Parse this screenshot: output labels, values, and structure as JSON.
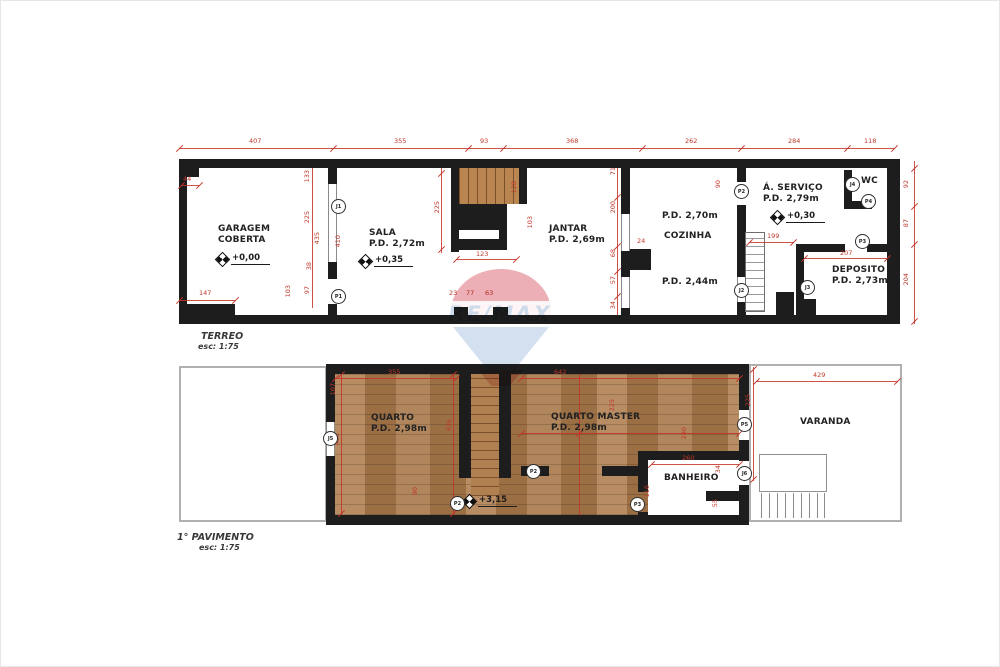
{
  "watermark": {
    "brand": "RE/MAX",
    "canopy_color": "#d95f6c",
    "bottom_color": "#a6c2e0"
  },
  "floors": [
    {
      "name": "TERREO",
      "scale": "esc: 1:75",
      "rooms": [
        {
          "lines": [
            "GARAGEM",
            "COBERTA"
          ],
          "x": 217,
          "y": 223
        },
        {
          "lines": [
            "SALA",
            "P.D. 2,72m"
          ],
          "x": 368,
          "y": 227
        },
        {
          "lines": [
            "JANTAR",
            "P.D. 2,69m"
          ],
          "x": 548,
          "y": 223
        },
        {
          "lines": [
            "P.D. 2,70m"
          ],
          "x": 661,
          "y": 210
        },
        {
          "lines": [
            "COZINHA"
          ],
          "x": 663,
          "y": 230
        },
        {
          "lines": [
            "P.D. 2,44m"
          ],
          "x": 661,
          "y": 276
        },
        {
          "lines": [
            "Á. SERVIÇO",
            "P.D. 2,79m"
          ],
          "x": 762,
          "y": 182
        },
        {
          "lines": [
            "WC"
          ],
          "x": 860,
          "y": 175
        },
        {
          "lines": [
            "DEPOSITO",
            "P.D. 2,73m"
          ],
          "x": 831,
          "y": 264
        }
      ],
      "levels": [
        {
          "t": "+0,00",
          "x": 216,
          "y": 252
        },
        {
          "t": "+0,35",
          "x": 359,
          "y": 254
        },
        {
          "t": "+0,30",
          "x": 771,
          "y": 210
        }
      ],
      "tags": [
        {
          "t": "J1",
          "x": 330,
          "y": 198
        },
        {
          "t": "P1",
          "x": 330,
          "y": 288
        },
        {
          "t": "P2",
          "x": 733,
          "y": 183
        },
        {
          "t": "J2",
          "x": 733,
          "y": 282
        },
        {
          "t": "J3",
          "x": 799,
          "y": 279
        },
        {
          "t": "J4",
          "x": 844,
          "y": 176
        },
        {
          "t": "P4",
          "x": 860,
          "y": 193
        },
        {
          "t": "P3",
          "x": 854,
          "y": 233
        }
      ],
      "dims": [
        {
          "t": "407",
          "x": 248,
          "y": 137
        },
        {
          "t": "355",
          "x": 393,
          "y": 137
        },
        {
          "t": "93",
          "x": 479,
          "y": 137
        },
        {
          "t": "368",
          "x": 565,
          "y": 137
        },
        {
          "t": "262",
          "x": 684,
          "y": 137
        },
        {
          "t": "284",
          "x": 787,
          "y": 137
        },
        {
          "t": "118",
          "x": 863,
          "y": 137
        },
        {
          "t": "44",
          "x": 182,
          "y": 175
        },
        {
          "t": "147",
          "x": 198,
          "y": 289
        },
        {
          "t": "123",
          "x": 475,
          "y": 250
        },
        {
          "t": "199",
          "x": 766,
          "y": 232
        },
        {
          "t": "207",
          "x": 839,
          "y": 249
        },
        {
          "t": "23",
          "x": 448,
          "y": 289
        },
        {
          "t": "77",
          "x": 465,
          "y": 289
        },
        {
          "t": "63",
          "x": 484,
          "y": 289
        },
        {
          "t": "24",
          "x": 636,
          "y": 237
        },
        {
          "t": "133",
          "x": 303,
          "y": 169,
          "r": 1
        },
        {
          "t": "225",
          "x": 303,
          "y": 210,
          "r": 1
        },
        {
          "t": "435",
          "x": 313,
          "y": 231,
          "r": 1
        },
        {
          "t": "410",
          "x": 334,
          "y": 234,
          "r": 1
        },
        {
          "t": "38",
          "x": 305,
          "y": 261,
          "r": 1
        },
        {
          "t": "103",
          "x": 284,
          "y": 284,
          "r": 1
        },
        {
          "t": "97",
          "x": 303,
          "y": 285,
          "r": 1
        },
        {
          "t": "225",
          "x": 433,
          "y": 200,
          "r": 1
        },
        {
          "t": "128",
          "x": 510,
          "y": 180,
          "r": 1
        },
        {
          "t": "103",
          "x": 526,
          "y": 215,
          "r": 1
        },
        {
          "t": "71",
          "x": 609,
          "y": 166,
          "r": 1
        },
        {
          "t": "200",
          "x": 609,
          "y": 200,
          "r": 1
        },
        {
          "t": "68",
          "x": 609,
          "y": 248,
          "r": 1
        },
        {
          "t": "57",
          "x": 609,
          "y": 275,
          "r": 1
        },
        {
          "t": "34",
          "x": 609,
          "y": 300,
          "r": 1
        },
        {
          "t": "90",
          "x": 714,
          "y": 179,
          "r": 1
        },
        {
          "t": "92",
          "x": 902,
          "y": 179,
          "r": 1
        },
        {
          "t": "87",
          "x": 902,
          "y": 218,
          "r": 1
        },
        {
          "t": "204",
          "x": 902,
          "y": 272,
          "r": 1
        }
      ],
      "red_lines": [
        [
          178,
          147,
          715,
          1
        ],
        [
          178,
          299,
          56,
          1
        ],
        [
          455,
          258,
          60,
          1
        ],
        [
          748,
          241,
          44,
          1
        ],
        [
          803,
          257,
          83,
          1
        ],
        [
          913,
          160,
          1,
          163
        ],
        [
          616,
          167,
          1,
          147
        ],
        [
          311,
          167,
          1,
          140
        ],
        [
          440,
          167,
          1,
          85
        ],
        [
          180,
          184,
          18,
          1
        ]
      ],
      "ticks": [
        [
          178,
          147
        ],
        [
          332,
          147
        ],
        [
          467,
          147
        ],
        [
          502,
          147
        ],
        [
          641,
          147
        ],
        [
          740,
          147
        ],
        [
          846,
          147
        ],
        [
          893,
          147
        ],
        [
          178,
          299
        ],
        [
          234,
          299
        ],
        [
          455,
          258
        ],
        [
          515,
          258
        ],
        [
          748,
          241
        ],
        [
          792,
          241
        ],
        [
          803,
          257
        ],
        [
          886,
          257
        ],
        [
          913,
          167
        ],
        [
          913,
          205
        ],
        [
          913,
          243
        ],
        [
          913,
          320
        ],
        [
          616,
          196
        ],
        [
          616,
          245
        ],
        [
          616,
          270
        ],
        [
          616,
          295
        ],
        [
          440,
          172
        ],
        [
          440,
          248
        ],
        [
          180,
          184
        ],
        [
          198,
          184
        ]
      ]
    },
    {
      "name": "1° PAVIMENTO",
      "scale": "esc: 1:75",
      "rooms": [
        {
          "lines": [
            "QUARTO",
            "P.D. 2,98m"
          ],
          "x": 370,
          "y": 412
        },
        {
          "lines": [
            "QUARTO MASTER",
            "P.D. 2,98m"
          ],
          "x": 550,
          "y": 411
        },
        {
          "lines": [
            "BANHEIRO"
          ],
          "x": 663,
          "y": 472
        },
        {
          "lines": [
            "VARANDA"
          ],
          "x": 799,
          "y": 416
        }
      ],
      "levels": [
        {
          "t": "+3,15",
          "x": 463,
          "y": 494
        }
      ],
      "tags": [
        {
          "t": "J5",
          "x": 322,
          "y": 430
        },
        {
          "t": "P2",
          "x": 449,
          "y": 495
        },
        {
          "t": "P2",
          "x": 525,
          "y": 463
        },
        {
          "t": "P3",
          "x": 629,
          "y": 496
        },
        {
          "t": "P5",
          "x": 736,
          "y": 416
        },
        {
          "t": "J6",
          "x": 736,
          "y": 465
        }
      ],
      "dims": [
        {
          "t": "355",
          "x": 387,
          "y": 368
        },
        {
          "t": "642",
          "x": 553,
          "y": 368
        },
        {
          "t": "429",
          "x": 812,
          "y": 371
        },
        {
          "t": "260",
          "x": 681,
          "y": 454
        },
        {
          "t": "225",
          "x": 744,
          "y": 393,
          "r": 1
        },
        {
          "t": "107",
          "x": 329,
          "y": 382,
          "r": 1
        },
        {
          "t": "438",
          "x": 333,
          "y": 432,
          "r": 1
        },
        {
          "t": "436",
          "x": 445,
          "y": 418,
          "r": 1
        },
        {
          "t": "225",
          "x": 608,
          "y": 398,
          "r": 1
        },
        {
          "t": "280",
          "x": 680,
          "y": 426,
          "r": 1
        },
        {
          "t": "90",
          "x": 411,
          "y": 486,
          "r": 1
        },
        {
          "t": "34",
          "x": 714,
          "y": 464,
          "r": 1
        },
        {
          "t": "55",
          "x": 711,
          "y": 498,
          "r": 1
        },
        {
          "t": "116",
          "x": 643,
          "y": 484,
          "r": 1
        }
      ],
      "red_lines": [
        [
          334,
          377,
          121,
          1
        ],
        [
          520,
          377,
          218,
          1
        ],
        [
          755,
          380,
          141,
          1
        ],
        [
          752,
          366,
          1,
          114
        ],
        [
          340,
          373,
          1,
          141
        ],
        [
          452,
          373,
          1,
          141
        ],
        [
          578,
          373,
          1,
          141
        ],
        [
          520,
          432,
          218,
          1
        ],
        [
          650,
          463,
          88,
          1
        ]
      ],
      "ticks": [
        [
          334,
          377
        ],
        [
          455,
          377
        ],
        [
          520,
          377
        ],
        [
          738,
          377
        ],
        [
          755,
          380
        ],
        [
          896,
          380
        ],
        [
          650,
          463
        ],
        [
          738,
          463
        ],
        [
          340,
          373
        ],
        [
          340,
          512
        ],
        [
          452,
          373
        ],
        [
          452,
          512
        ],
        [
          752,
          368
        ],
        [
          752,
          478
        ],
        [
          578,
          432
        ],
        [
          520,
          432
        ],
        [
          738,
          432
        ]
      ]
    }
  ]
}
